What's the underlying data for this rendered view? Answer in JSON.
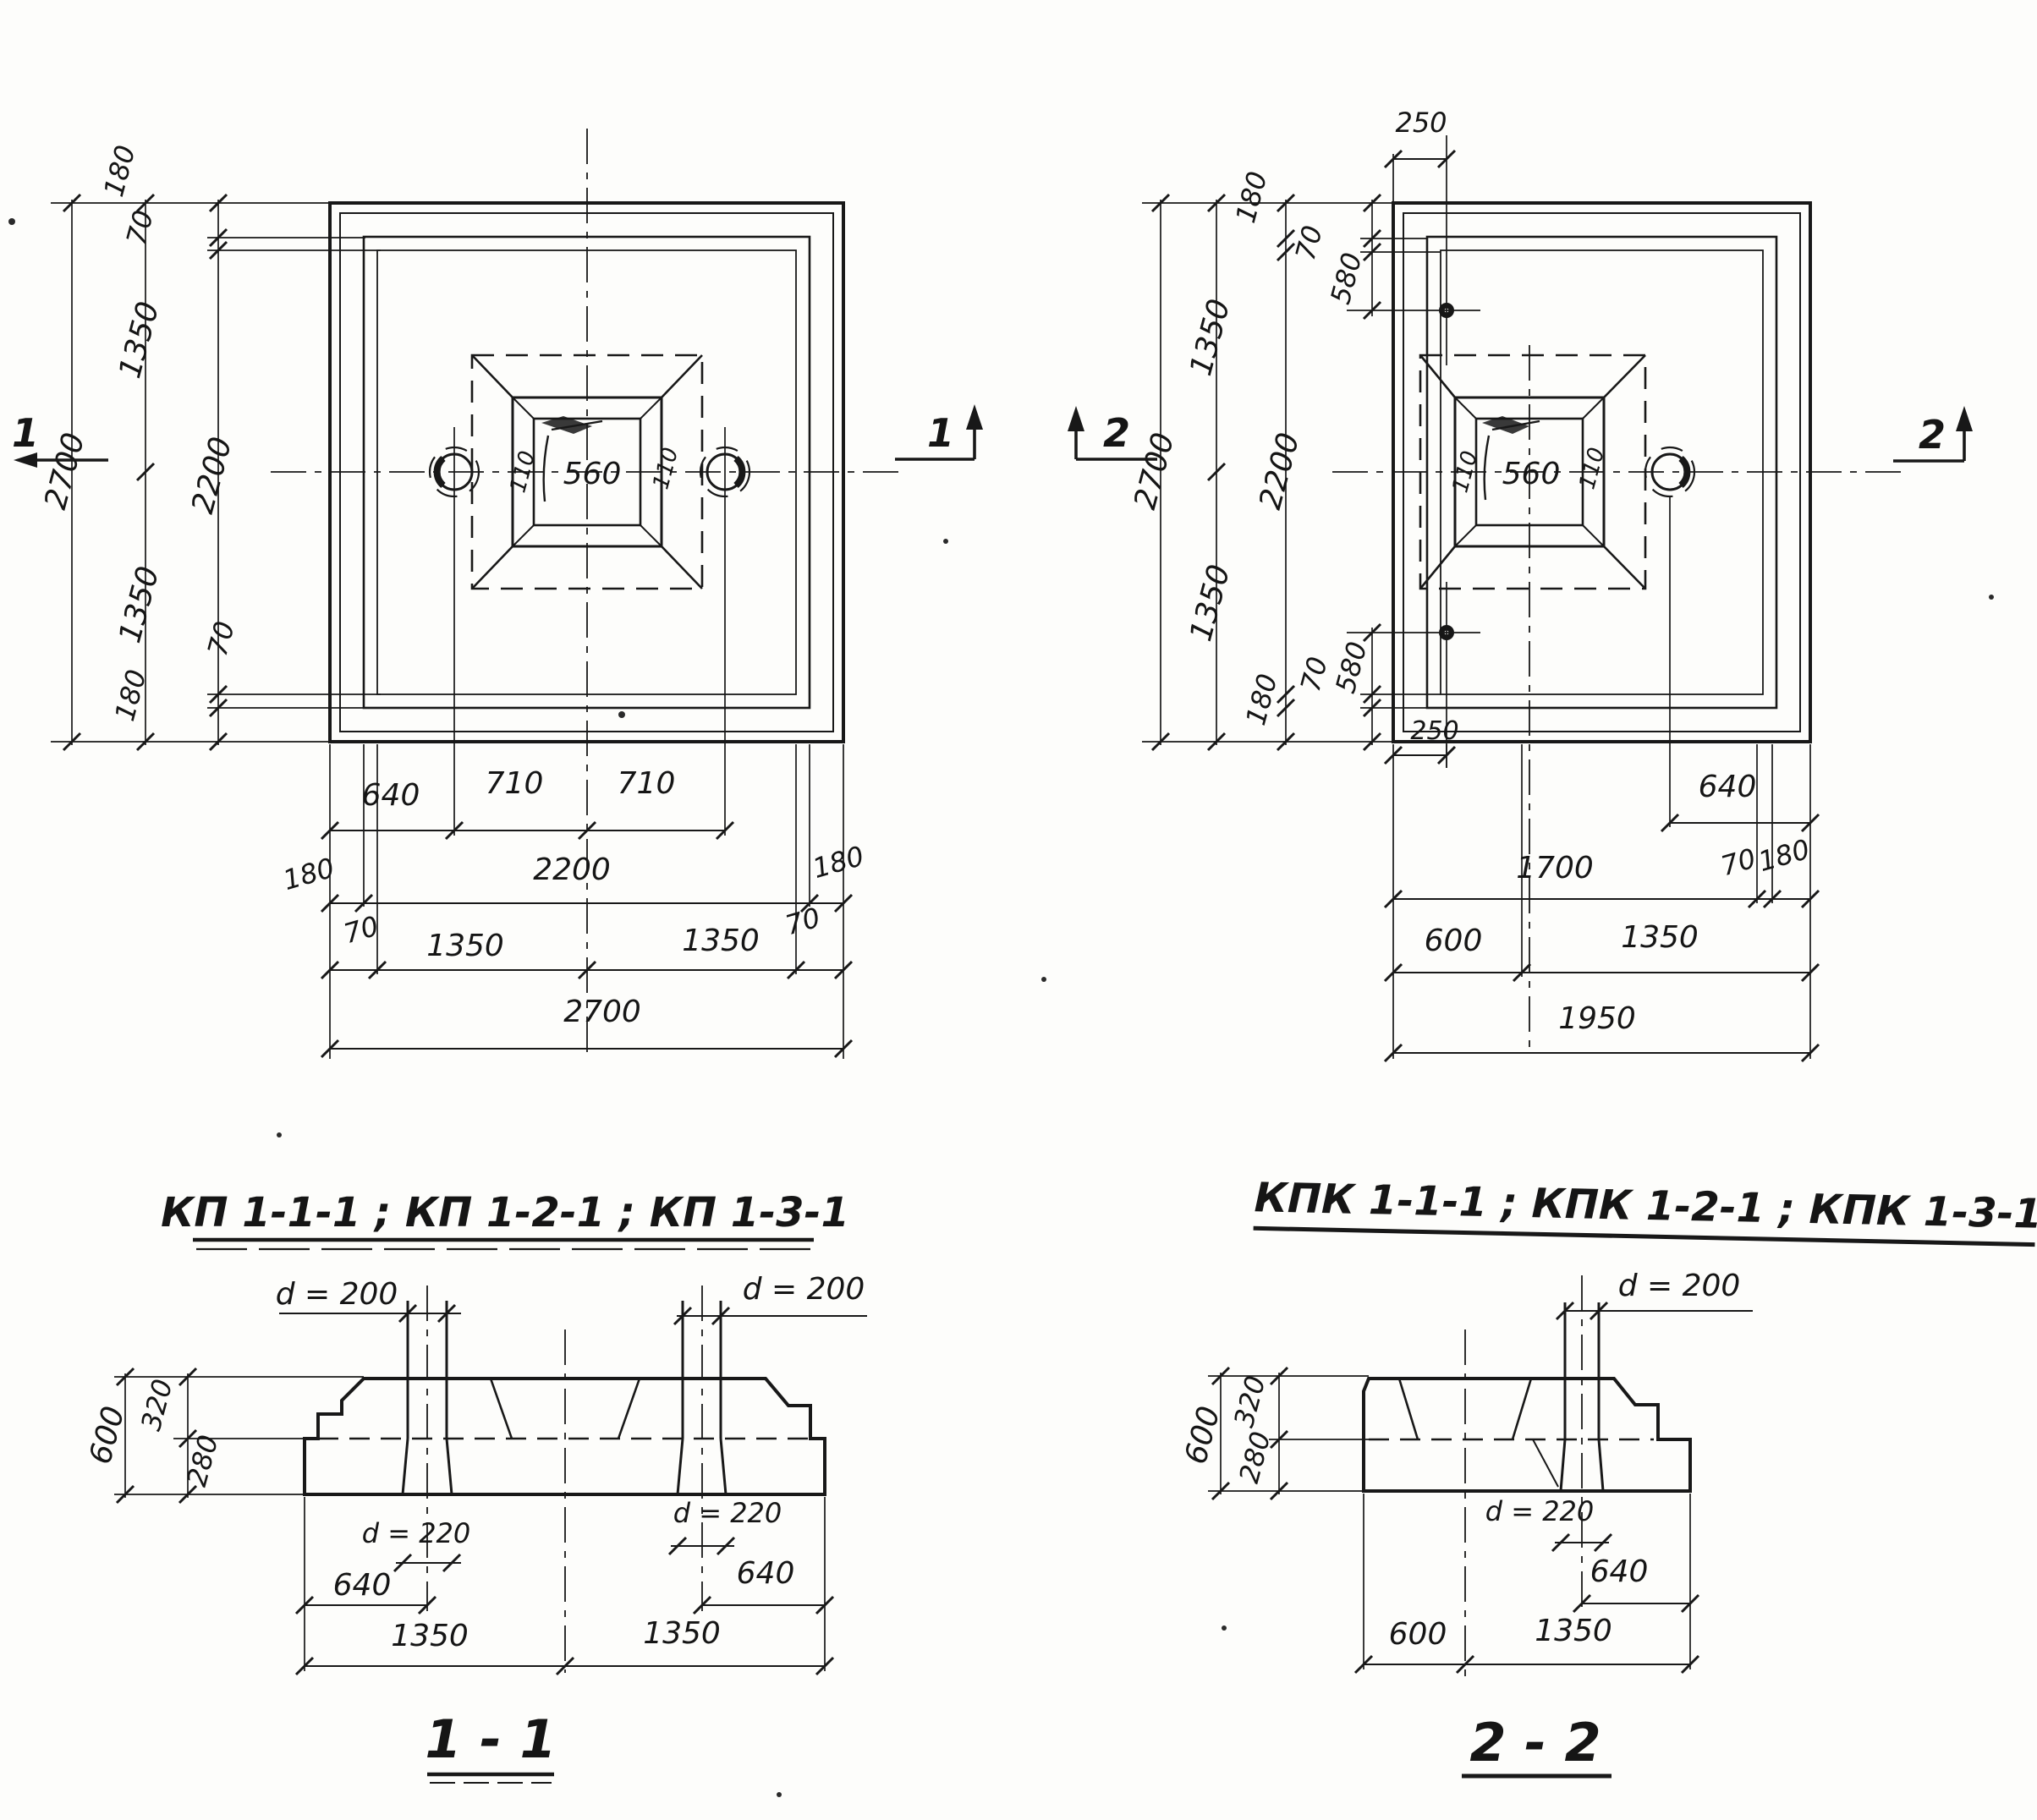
{
  "titles": {
    "plan_left": "КП 1-1-1 ; КП 1-2-1 ; КП 1-3-1",
    "plan_right": "КПК 1-1-1 ; КПК 1-2-1 ; КПК 1-3-1",
    "section_left": "1 - 1",
    "section_right": "2 - 2"
  },
  "markers": {
    "one": "1",
    "two": "2"
  },
  "plan_left": {
    "left_chain": {
      "total": "2700",
      "half_top": "1350",
      "half_bottom": "1350",
      "inner": "2200",
      "edge_top": "180",
      "step_top": "70",
      "step_bottom": "70",
      "edge_bottom": "180"
    },
    "pocket": {
      "left": "110",
      "size": "560",
      "right": "110"
    },
    "rows": {
      "r1": [
        "640",
        "710",
        "710"
      ],
      "r2": [
        "180",
        "2200",
        "180"
      ],
      "r3": [
        "70",
        "1350",
        "1350",
        "70"
      ],
      "r4": "2700"
    }
  },
  "plan_right": {
    "top_offset": "250",
    "bottom_offset": "250",
    "left_chain": {
      "total": "2700",
      "half_top": "1350",
      "half_bottom": "1350",
      "inner": "2200",
      "edge_top": "180",
      "step_top": "70",
      "hole_top": "580",
      "hole_bottom": "580",
      "step_bottom": "70",
      "edge_bottom": "180"
    },
    "pocket": {
      "left": "110",
      "size": "560",
      "right": "110"
    },
    "rows": {
      "r1": "640",
      "r2": [
        "1700",
        "70",
        "180"
      ],
      "r3": [
        "600",
        "1350"
      ],
      "r4": "1950"
    }
  },
  "section_1": {
    "piers": {
      "left": "d = 200",
      "right": "d = 200"
    },
    "heights": {
      "total": "600",
      "top": "320",
      "bottom": "280"
    },
    "holes": {
      "left": "d = 220",
      "right": "d = 220"
    },
    "offsets": {
      "left": "640",
      "right": "640"
    },
    "row": [
      "1350",
      "1350"
    ]
  },
  "section_2": {
    "pier": "d = 200",
    "heights": {
      "total": "600",
      "top": "320",
      "bottom": "280"
    },
    "hole": "d = 220",
    "offset": "640",
    "row": [
      "600",
      "1350"
    ]
  }
}
